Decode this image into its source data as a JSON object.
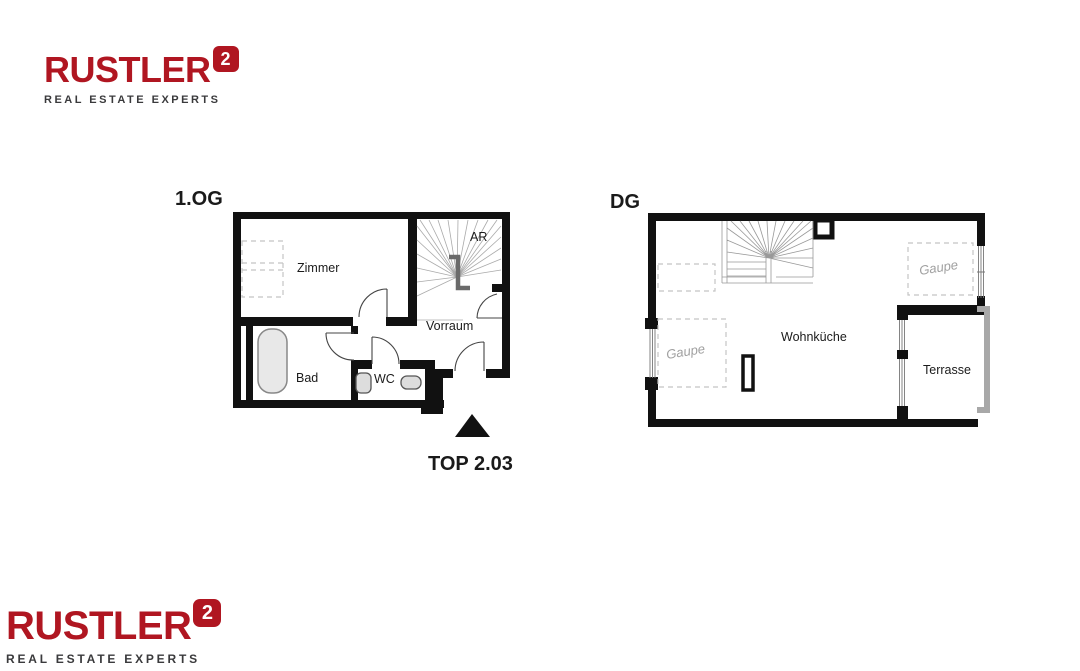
{
  "brand": {
    "name": "RUSTLER",
    "tagline": "REAL ESTATE EXPERTS",
    "mark_glyph": "2",
    "red": "#B01621",
    "gray": "#3A3A3C"
  },
  "unit_label": "TOP 2.03",
  "plans": {
    "og": {
      "title": "1.OG",
      "rooms": {
        "zimmer": "Zimmer",
        "ar": "AR",
        "vorraum": "Vorraum",
        "bad": "Bad",
        "wc": "WC"
      }
    },
    "dg": {
      "title": "DG",
      "rooms": {
        "wohnkueche": "Wohnküche",
        "terrasse": "Terrasse",
        "gaupe_left": "Gaupe",
        "gaupe_right": "Gaupe"
      }
    }
  }
}
